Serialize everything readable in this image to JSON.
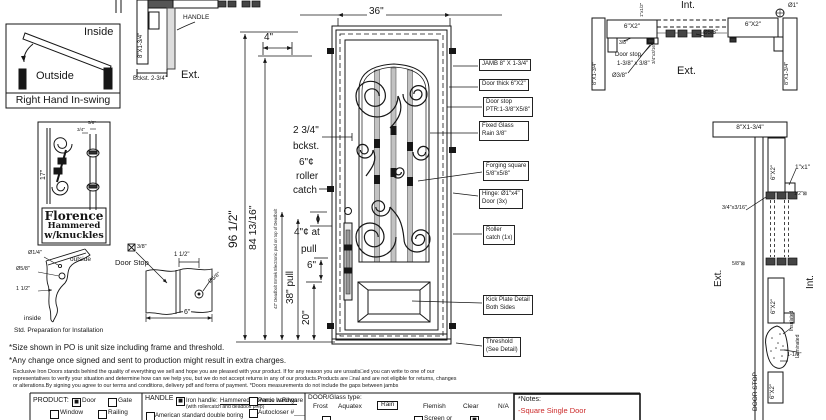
{
  "colors": {
    "accent_red": "#cc2a2a"
  },
  "swing": {
    "inside": "Inside",
    "outside": "Outside",
    "title": "Right Hand In-swing"
  },
  "plan_left": {
    "jamb": "8\"X1-3/4\"",
    "handle_label": "HANDLE",
    "backset": "Bckst. 2-3/4\"",
    "ext_label": "Ext."
  },
  "florence": {
    "dim_17": "17\"",
    "dim_58": "5/8\"",
    "dim_34": "3/4\"",
    "name": "Florence",
    "finish": "Hammered",
    "detail": "w/knuckles"
  },
  "corner_detail": {
    "dia_quarter": "Ø1/4\"",
    "outside_label": "outside",
    "dia_58": "Ø5/8\"",
    "dim_1half": "1 1/2\"",
    "inside_label": "inside",
    "caption": "Std. Preparation for Installation"
  },
  "stop_detail": {
    "dim_38": "3/8\"",
    "title": "Door Stop",
    "dim_1half": "1 1/2\"",
    "dia_58": "Ø5/8\"",
    "dim_6": "6\""
  },
  "door": {
    "dim_36": "36\"",
    "dim_4": "4\"",
    "dim_96": "96 1/2\"",
    "dim_84": "84 13/16\"",
    "deadbolt_note": "42\" Deadbolt Emtek Electronic pad on top of Deadbolt",
    "backset_val": "2 3/4\"",
    "backset_word": "bckst.",
    "roller_l1": "6\"¢",
    "roller_l2": "roller",
    "roller_l3": "catch",
    "pull_l1": "4\"¢ at",
    "pull_l2": "pull",
    "dim_6": "6\"",
    "dim_38pull": "38\" pull",
    "dim_20": "20\""
  },
  "callouts": {
    "jamb": "JAMB 8\" X 1-3/4\"",
    "door_thick": "Door thick 6\"X2\"",
    "door_stop_1": "Door stop",
    "door_stop_2": "PTR:1-3/8\"X5/8\"",
    "glass_1": "Fixed Glass",
    "glass_2": "Rain 3/8\"",
    "forging_1": "Forging square",
    "forging_2": "5/8\"x5/8\"",
    "hinge_1": "Hinge: Ø1\"x4\"",
    "hinge_2": "Door (3x)",
    "roller_1": "Roller",
    "roller_2": "catch  (1x)",
    "kick_1": "Kick Plate Detail",
    "kick_2": "Both Sides",
    "threshold_1": "Threshold",
    "threshold_2": "(See Detail)"
  },
  "plan_right": {
    "int_label": "Int.",
    "ext_label": "Ext.",
    "jamb_left": "8\"X1-3/4\"",
    "head_left": "6\"X2\"",
    "head_right": "6\"X2\"",
    "jamb_right": "8\"X1-3/4\"",
    "dim_38": "3/8\"",
    "door_stop": "Door stop",
    "door_stop_size": "1-3/8\" x 3/8\"",
    "dia_38": "Ø3/8\"",
    "dia_58": "Ø5/8\"",
    "dia_1": "Ø1\"",
    "dim_edge": "3/4\"x3/16\"",
    "dim_top": "1\"x1/2\""
  },
  "section_right": {
    "header": "8\"X1-3/4\"",
    "box1": "6\"X2\"",
    "box2": "6\"X2\"",
    "box3": "6\"X2\"",
    "dim_1x1": "1\"x1\"",
    "dim_half": "1/2\"⊠",
    "dim_edge": "3/4\"x3/16\"",
    "ext_label": "Ext.",
    "int_label": "Int.",
    "dim_58": "5/8\"⊠",
    "insulated": "Insulated",
    "laminated": "Laminated",
    "dim_1half": "1-1/2\"",
    "door_stop": "DOOR STOP"
  },
  "notes": {
    "note1": "*Size shown in PO is unit size including frame and threshold.",
    "note2": "*Any change once signed and sent to production might result in extra charges.",
    "fine1": "Exclusive Iron Doors stands behind the quality of everything we sell and hope you are pleased with your product. If for any reason you are unsatis□ed you can write to one of our",
    "fine2": "representatives to verify your situation and determine how can we help you, but we do not accept returns in any of our products.Products are □nal and are not eligible for returns, changes",
    "fine3": "or alterations.By signing you agree to our terms and conditions, delivery pdf and forms of payment. *Doors measurements do not include the gaps between jambs"
  },
  "form": {
    "product_label": "PRODUCT:",
    "product_options": [
      {
        "mark": "■",
        "label": "Door"
      },
      {
        "mark": "",
        "label": "Gate"
      },
      {
        "mark": "",
        "label": "Window"
      },
      {
        "mark": "",
        "label": "Railing"
      }
    ],
    "handle_label": "HANDLE",
    "handle_mark": "■",
    "handle_text": "Iron handle:",
    "handle_name": "Hammered Florence w.Rings",
    "handle_sub": "(with rollercatch and deadbolt prep)",
    "handle_opt2": "American standard double boring",
    "panic": "Panic hardware",
    "autocloser": "Autocloser #___",
    "glass_label": "DOOR/Glass type:",
    "glass_options": [
      {
        "mark": "",
        "label": "Frost"
      },
      {
        "mark": "",
        "label": "Aquatex"
      },
      {
        "mark": "",
        "label": "Rain",
        "selected": true
      },
      {
        "mark": "",
        "label": "Flemish"
      },
      {
        "mark": "",
        "label": "Clear"
      },
      {
        "mark": "",
        "label": "N/A"
      }
    ],
    "screen_or": "Screen or",
    "notes_label": "*Notes:",
    "notes_value": "-Square Single Door"
  }
}
